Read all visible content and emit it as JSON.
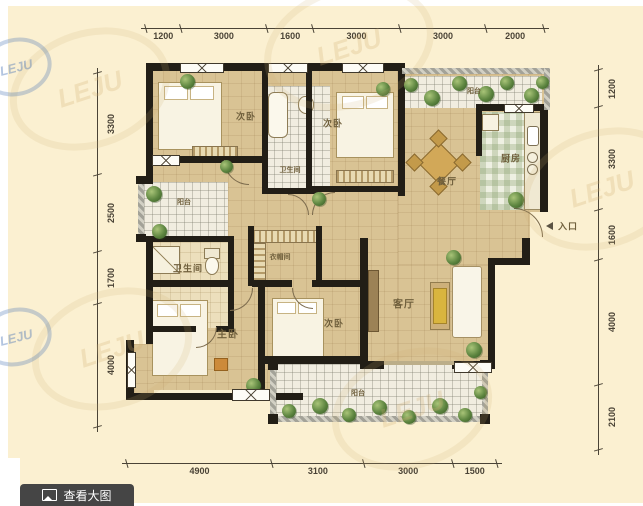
{
  "watermark": {
    "text": "LEJU"
  },
  "toolbar": {
    "view_large_label": "查看大图"
  },
  "dimensions": {
    "top": [
      1200,
      3000,
      1600,
      3000,
      3000,
      2000
    ],
    "bottom": [
      4900,
      3100,
      3000,
      1500
    ],
    "left": [
      3300,
      2500,
      1700,
      4000
    ],
    "right": [
      1200,
      3300,
      1600,
      4000,
      2100
    ]
  },
  "rooms": {
    "bedroom_top_left": {
      "label": "次卧"
    },
    "bath_top": {
      "label": "卫生间"
    },
    "bedroom_top_mid": {
      "label": "次卧"
    },
    "balcony_top": {
      "label": "阳台"
    },
    "kitchen": {
      "label": "厨房"
    },
    "dining": {
      "label": "餐厅"
    },
    "entrance": {
      "label": "入口"
    },
    "balcony_left": {
      "label": "阳台"
    },
    "bath_left": {
      "label": "卫生间"
    },
    "closet": {
      "label": "衣帽间"
    },
    "living": {
      "label": "客厅"
    },
    "master": {
      "label": "主卧"
    },
    "bedroom_bottom": {
      "label": "次卧"
    },
    "balcony_bottom": {
      "label": "阳台"
    }
  },
  "colors": {
    "wall": "#221e16",
    "floor_tan": "#d9c394",
    "canvas_bg": "#fbf0d1",
    "button_bg": "#454545",
    "watermark_blue": "#4a74b4"
  }
}
